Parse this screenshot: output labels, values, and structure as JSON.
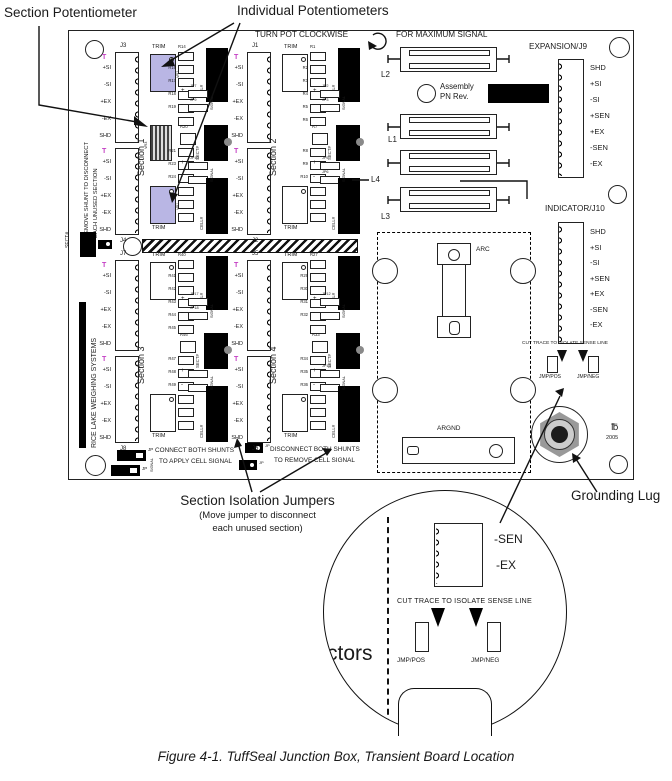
{
  "annotations": {
    "section_potentiometer": "Section Potentiometer",
    "individual_potentiometers": "Individual Potentiometers",
    "section_isolation_jumpers": "Section Isolation Jumpers",
    "isolation_note_line1": "(Move jumper to disconnect",
    "isolation_note_line2": "each unused section)",
    "grounding_lug": "Grounding Lug",
    "caption": "Figure 4-1. TuffSeal Junction Box, Transient Board Location"
  },
  "board": {
    "turn_pot_note": "TURN POT CLOCKWISE",
    "max_signal_note": "FOR MAXIMUM SIGNAL",
    "assembly_line1": "Assembly",
    "assembly_line2": "PN Rev.",
    "remove_shunt_line1": "REMOVE SHUNT TO DISCONNECT",
    "remove_shunt_line2": "EACH UNUSED SECTION",
    "brand": "RICE LAKE WEIGHING SYSTEMS",
    "sect_label": "SECT#",
    "cell_label": "CELL#",
    "trim_label": "TRIM",
    "signal_label": "SIGNAL",
    "jp_label": "JP",
    "plus": "+",
    "minus": "-",
    "tee": "T",
    "year": "2005",
    "logo_mark": "℔",
    "arc_label": "ARC",
    "argnd_label": "ARGND",
    "inductors": [
      "L2",
      "L1",
      "L4",
      "L3"
    ],
    "pin_labels": [
      "+SI",
      "-SI",
      "+EX",
      "-EX",
      "SHD"
    ],
    "connect_note_line1": "CONNECT BOTH SHUNTS",
    "connect_note_line2": "TO APPLY CELL SIGNAL",
    "disconnect_note_line1": "DISCONNECT BOTH SHUNTS",
    "disconnect_note_line2": "TO REMOVE CELL SIGNAL",
    "expansion": {
      "title": "EXPANSION/J9",
      "pins": [
        "SHD",
        "+SI",
        "-SI",
        "+SEN",
        "+EX",
        "-SEN",
        "-EX"
      ]
    },
    "indicator": {
      "title": "INDICATOR/J10",
      "pins": [
        "SHD",
        "+SI",
        "-SI",
        "+SEN",
        "+EX",
        "-SEN",
        "-EX"
      ],
      "cut_trace_note": "CUT TRACE TO ISOLATE SENSE LINE",
      "jmp_pos": "JMP/POS",
      "jmp_neg": "JMP/NEG"
    },
    "sections": [
      {
        "label": "Section 1",
        "j_top": "J3",
        "j_bottom": "J4",
        "highlighted": true,
        "striped_pot": true,
        "vr_top": "VR2",
        "vr_mid": "VR3",
        "vr_bottom": "VR1",
        "mid_resistor": "R20",
        "resistors_top": [
          "R14",
          "R16",
          "R17",
          "R18",
          "R19"
        ],
        "resistors_bottom": [
          "R21",
          "R23",
          "R24",
          "R26"
        ],
        "jp_top": [
          "JP7",
          "JP9"
        ],
        "jp_bottom": [
          "JP10"
        ]
      },
      {
        "label": "Section 2",
        "j_top": "J1",
        "j_bottom": "J2",
        "highlighted": false,
        "striped_pot": false,
        "mid_resistor": "R7",
        "resistors_top": [
          "R1",
          "R2",
          "R3",
          "R4",
          "R5",
          "R6"
        ],
        "resistors_bottom": [
          "R8",
          "R9",
          "R10",
          "R11",
          "R12",
          "R13"
        ],
        "jp_top": [
          "JP2",
          "JP3"
        ],
        "jp_bottom": [
          "JP5",
          "JP6"
        ]
      },
      {
        "label": "Section 3",
        "j_top": "J7",
        "j_bottom": "J8",
        "highlighted": false,
        "striped_pot": false,
        "mid_resistor": "R46",
        "resistors_top": [
          "R40",
          "R41",
          "R42",
          "R43",
          "R44",
          "R45"
        ],
        "resistors_bottom": [
          "R47",
          "R48",
          "R49",
          "R50",
          "R51",
          "R52"
        ],
        "jp_top": [
          "JP17",
          "JP18"
        ],
        "jp_bottom": []
      },
      {
        "label": "Section 4",
        "j_top": "J5",
        "j_bottom": "J6",
        "highlighted": false,
        "striped_pot": false,
        "mid_resistor": "R33",
        "resistors_top": [
          "R27",
          "R29",
          "R30",
          "R31",
          "R32"
        ],
        "resistors_bottom": [
          "R34",
          "R35",
          "R36",
          "R39"
        ],
        "jp_top": [
          "JP12"
        ],
        "jp_bottom": [
          "JP13"
        ]
      }
    ]
  },
  "inset": {
    "sen": "-SEN",
    "ex": "-EX",
    "cut_trace_note": "CUT TRACE TO ISOLATE SENSE LINE",
    "jmp_pos": "JMP/POS",
    "jmp_neg": "JMP/NEG",
    "partial_text": "ctors"
  },
  "colors": {
    "pot_highlight": "#b9b6e4",
    "magenta": "#c43fc4",
    "board_line": "#1a1a1a"
  }
}
